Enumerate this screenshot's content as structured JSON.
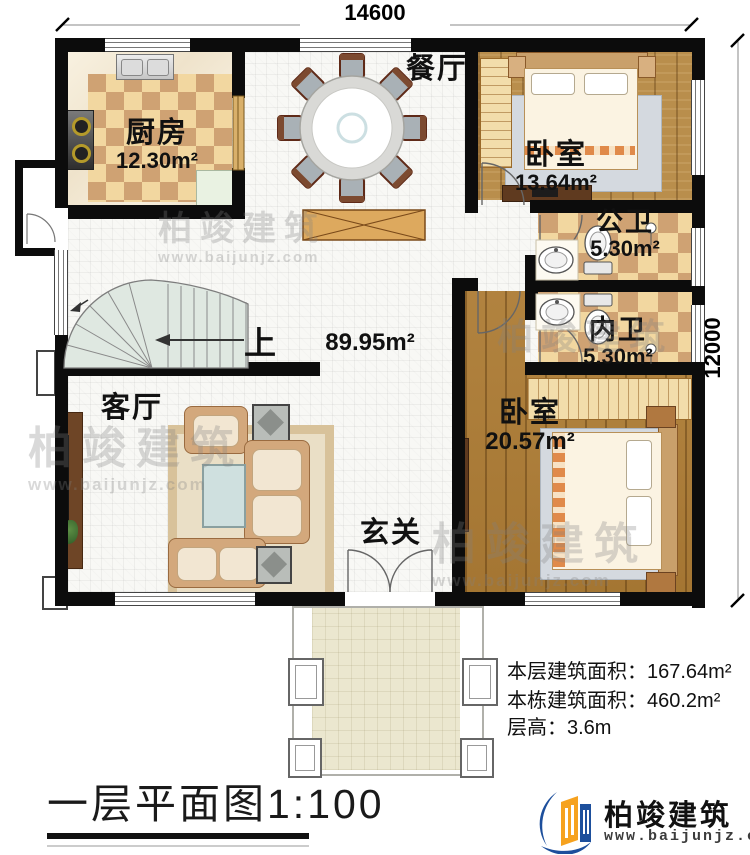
{
  "dimensions": {
    "top": "14600",
    "right": "12000"
  },
  "rooms": {
    "dining": {
      "name": "餐厅"
    },
    "kitchen": {
      "name": "厨房",
      "area": "12.30m²"
    },
    "bedroom1": {
      "name": "卧室",
      "area": "13.64m²"
    },
    "public_bath": {
      "name": "公卫",
      "area": "5.30m²"
    },
    "private_bath": {
      "name": "内卫",
      "area": "5.30m²"
    },
    "bedroom2": {
      "name": "卧室",
      "area": "20.57m²"
    },
    "living": {
      "name": "客厅"
    },
    "foyer": {
      "name": "玄关"
    },
    "stairs_up_label": "上",
    "central_area": "89.95m²"
  },
  "stats": [
    {
      "label": "本层建筑面积：",
      "value": "167.64m²"
    },
    {
      "label": "本栋建筑面积：",
      "value": "460.2m²"
    },
    {
      "label": "层高：",
      "value": "3.6m"
    }
  ],
  "title": "一层平面图1:100",
  "brand": {
    "name": "柏竣建筑",
    "url": "www.baijunjz.com"
  },
  "watermark": {
    "name": "柏竣建筑",
    "url": "www.baijunjz.com"
  },
  "colors": {
    "wall": "#0c0c0c",
    "accent_blue": "#1d4f9c",
    "accent_orange": "#f6a21f"
  }
}
